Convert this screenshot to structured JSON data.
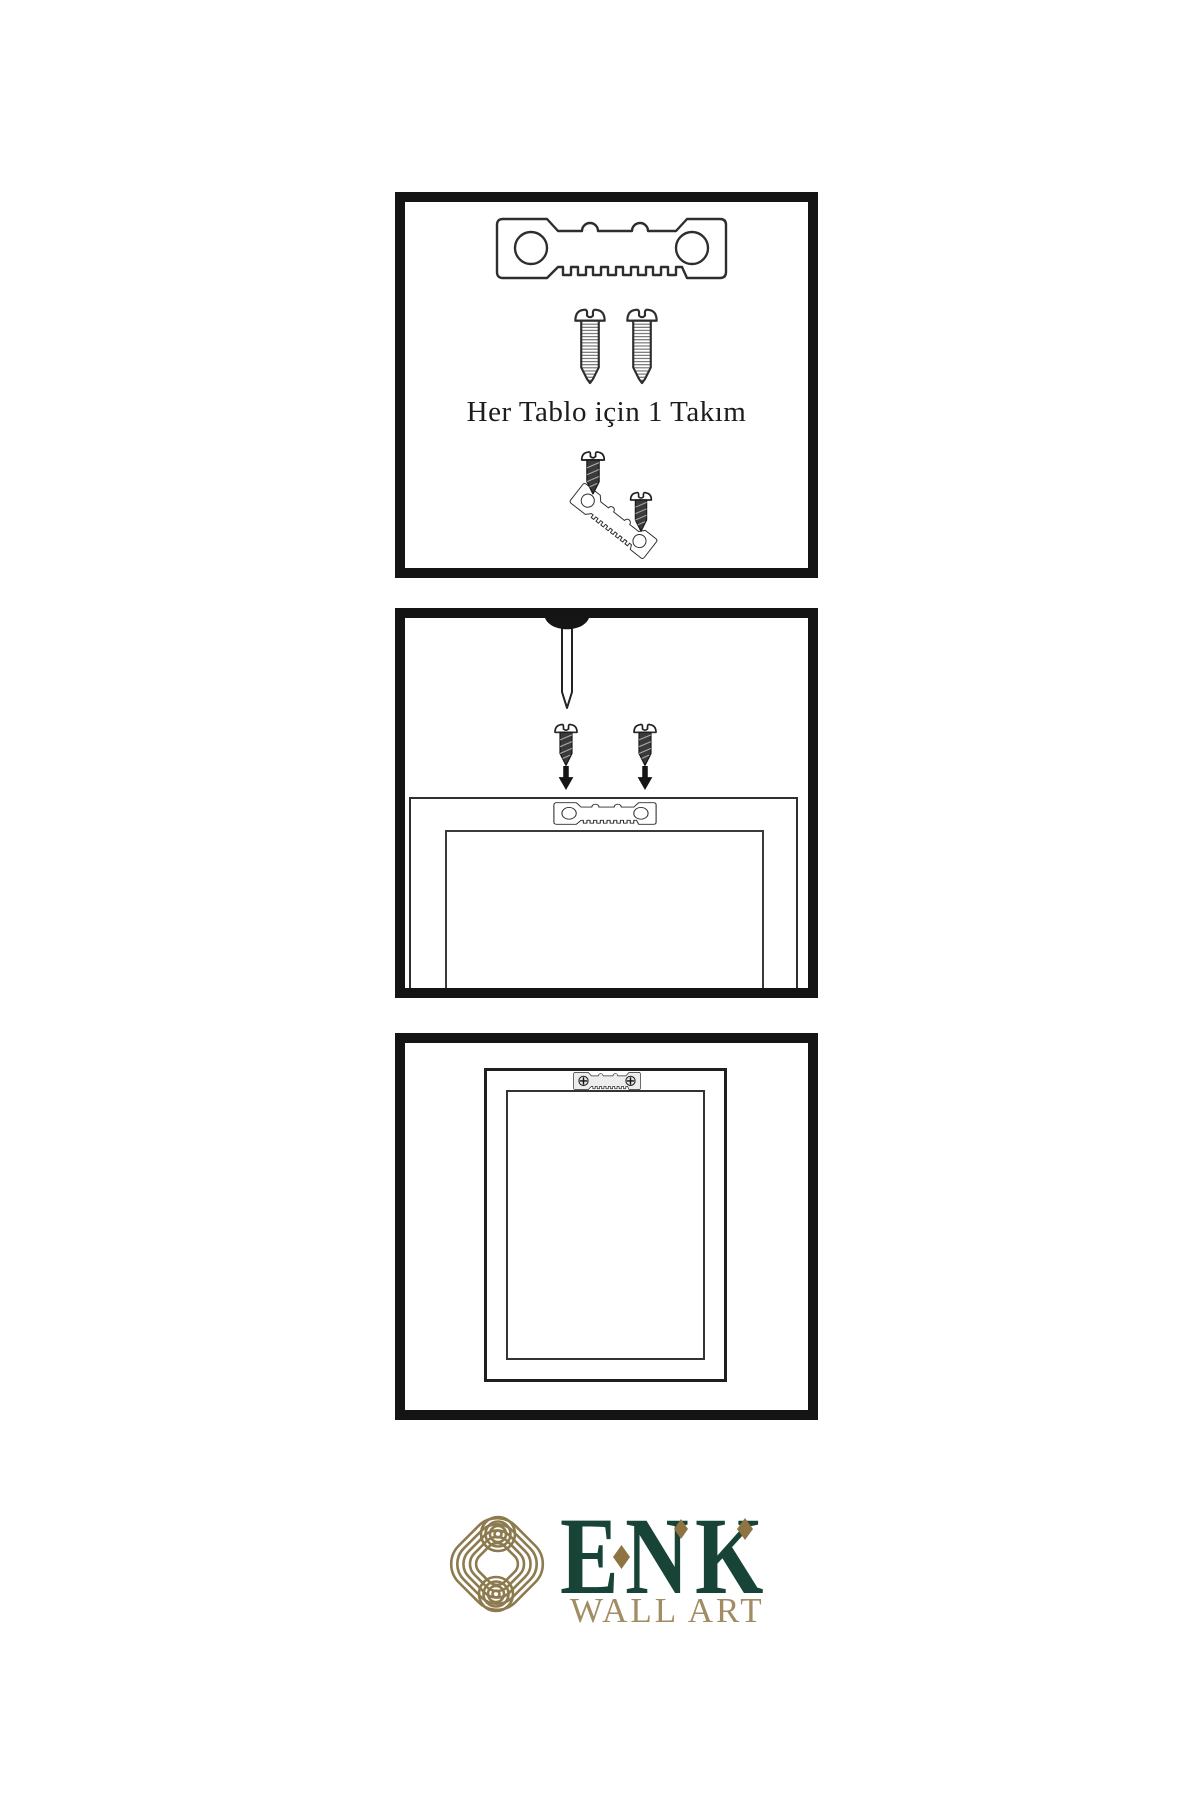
{
  "panel1": {
    "caption": "Her Tablo için 1 Takım"
  },
  "brand": {
    "name": "ENK",
    "tagline": "WALL ART"
  },
  "colors": {
    "background": "#ffffff",
    "panel_border": "#141414",
    "line_art": "#2e2e2e",
    "dark_screw_fill": "#3a3a3a",
    "brand_green": "#174437",
    "brand_gold_knot": "#8d7b4f",
    "brand_gold_diamond": "#8f7443",
    "brand_tan_text": "#a18c64"
  },
  "icons": {
    "sawtooth_hanger": "sawtooth-hanger-icon",
    "screw_outline": "screw-icon",
    "screw_dark": "dark-screw-icon",
    "nail": "nail-icon",
    "arrow_down": "down-arrow-icon",
    "knot_emblem": "knot-emblem-icon",
    "diamond_accent": "diamond-icon",
    "phillips_screw_head": "phillips-screw-icon"
  }
}
